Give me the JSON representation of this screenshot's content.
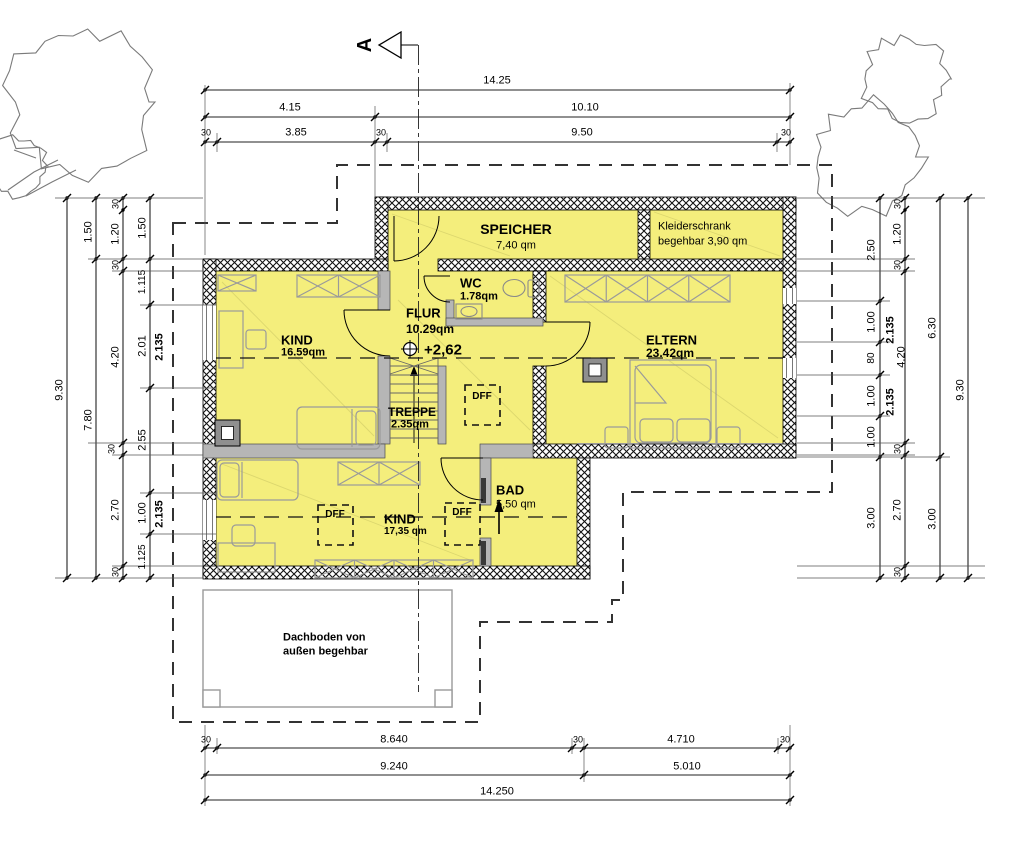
{
  "drawing": {
    "section_marker": "A",
    "attic_note": "Dachboden von außen begehbar",
    "roof_window_code": "DFF"
  },
  "rooms_summary": [
    {
      "name": "SPEICHER",
      "area": "7,40 qm"
    },
    {
      "name": "Kleiderschrank",
      "area": "begehbar 3,90 qm"
    },
    {
      "name": "WC",
      "area": "1.78qm"
    },
    {
      "name": "FLUR",
      "area": "10.29qm",
      "level": "+2,62"
    },
    {
      "name": "KIND",
      "area": "16.59qm"
    },
    {
      "name": "ELTERN",
      "area": "23.42qm"
    },
    {
      "name": "TREPPE",
      "area": "2.35qm"
    },
    {
      "name": "BAD",
      "area": "5,50 qm"
    },
    {
      "name": "KIND",
      "area": "17,35 qm"
    }
  ],
  "colors": {
    "room_fill": "#F4EE7C",
    "wall_gray": "#B6B6B6",
    "line_black": "#000000",
    "furniture_gray": "#9A9A9A",
    "tree_gray": "#7A7A7A"
  },
  "labels": {
    "rooms": [
      {
        "t": "SPEICHER",
        "x": 516,
        "y": 229,
        "s": 14,
        "b": 1,
        "n": "room-name-speicher"
      },
      {
        "t": "7,40 qm",
        "x": 516,
        "y": 246,
        "s": 11,
        "n": "room-area-speicher"
      },
      {
        "t": "Kleiderschrank",
        "x": 658,
        "y": 227,
        "s": 11,
        "a": "l",
        "n": "room-name-kleiderschrank"
      },
      {
        "t": "begehbar 3,90 qm",
        "x": 658,
        "y": 242,
        "s": 11,
        "a": "l",
        "n": "room-area-kleiderschrank"
      },
      {
        "t": "WC",
        "x": 460,
        "y": 283,
        "s": 13,
        "b": 1,
        "a": "l",
        "n": "room-name-wc"
      },
      {
        "t": "1.78qm",
        "x": 460,
        "y": 297,
        "s": 11,
        "b": 1,
        "a": "l",
        "n": "room-area-wc"
      },
      {
        "t": "FLUR",
        "x": 406,
        "y": 313,
        "s": 13,
        "b": 1,
        "a": "l",
        "n": "room-name-flur"
      },
      {
        "t": "10.29qm",
        "x": 406,
        "y": 329,
        "s": 12,
        "b": 1,
        "a": "l",
        "n": "room-area-flur"
      },
      {
        "t": "KIND",
        "x": 281,
        "y": 340,
        "s": 13,
        "b": 1,
        "a": "l",
        "n": "room-name-kind-1"
      },
      {
        "t": "16.59qm",
        "x": 281,
        "y": 353,
        "s": 11,
        "b": 1,
        "a": "l",
        "n": "room-area-kind-1"
      },
      {
        "t": "ELTERN",
        "x": 646,
        "y": 340,
        "s": 13,
        "b": 1,
        "a": "l",
        "n": "room-name-eltern"
      },
      {
        "t": "23.42qm",
        "x": 646,
        "y": 353,
        "s": 12,
        "b": 1,
        "a": "l",
        "n": "room-area-eltern"
      },
      {
        "t": "TREPPE",
        "x": 388,
        "y": 412,
        "s": 12,
        "b": 1,
        "a": "l",
        "n": "room-name-treppe"
      },
      {
        "t": "2.35qm",
        "x": 391,
        "y": 425,
        "s": 11,
        "b": 1,
        "a": "l",
        "n": "room-area-treppe"
      },
      {
        "t": "BAD",
        "x": 496,
        "y": 490,
        "s": 13,
        "b": 1,
        "a": "l",
        "n": "room-name-bad"
      },
      {
        "t": "5,50 qm",
        "x": 496,
        "y": 505,
        "s": 11,
        "a": "l",
        "n": "room-area-bad"
      },
      {
        "t": "KIND",
        "x": 384,
        "y": 519,
        "s": 13,
        "b": 1,
        "a": "l",
        "n": "room-name-kind-2"
      },
      {
        "t": "17,35 qm",
        "x": 384,
        "y": 532,
        "s": 10,
        "b": 1,
        "a": "l",
        "n": "room-area-kind-2"
      }
    ],
    "annotations": [
      {
        "t": "+2,62",
        "x": 424,
        "y": 350,
        "s": 15,
        "b": 1,
        "a": "l",
        "n": "level-annotation"
      },
      {
        "t": "DFF",
        "x": 482,
        "y": 397,
        "s": 10,
        "b": 1,
        "n": "dff-label-flur"
      },
      {
        "t": "DFF",
        "x": 335,
        "y": 515,
        "s": 10,
        "b": 1,
        "n": "dff-label-kind2-left"
      },
      {
        "t": "DFF",
        "x": 462,
        "y": 513,
        "s": 10,
        "b": 1,
        "n": "dff-label-kind2-right"
      },
      {
        "t": "Dachboden von",
        "x": 283,
        "y": 638,
        "s": 11,
        "b": 1,
        "a": "l",
        "n": "attic-note-line1"
      },
      {
        "t": "außen begehbar",
        "x": 283,
        "y": 652,
        "s": 11,
        "b": 1,
        "a": "l",
        "n": "attic-note-line2"
      },
      {
        "t": "A",
        "x": 365,
        "y": 45,
        "s": 20,
        "b": 1,
        "r": -90,
        "n": "section-marker-label"
      }
    ],
    "dims_top": [
      {
        "t": "14.25",
        "x": 497,
        "y": 81
      },
      {
        "t": "4.15",
        "x": 290,
        "y": 108
      },
      {
        "t": "10.10",
        "x": 585,
        "y": 108
      },
      {
        "t": "30",
        "x": 206,
        "y": 133,
        "s": 9
      },
      {
        "t": "3.85",
        "x": 296,
        "y": 133
      },
      {
        "t": "30",
        "x": 381,
        "y": 133,
        "s": 9
      },
      {
        "t": "9.50",
        "x": 582,
        "y": 133
      },
      {
        "t": "30",
        "x": 786,
        "y": 133,
        "s": 9
      }
    ],
    "dims_bottom": [
      {
        "t": "30",
        "x": 206,
        "y": 740,
        "s": 9
      },
      {
        "t": "8.640",
        "x": 394,
        "y": 740
      },
      {
        "t": "30",
        "x": 578,
        "y": 740,
        "s": 9
      },
      {
        "t": "4.710",
        "x": 681,
        "y": 740
      },
      {
        "t": "30",
        "x": 785,
        "y": 740,
        "s": 9
      },
      {
        "t": "9.240",
        "x": 394,
        "y": 767
      },
      {
        "t": "5.010",
        "x": 687,
        "y": 767
      },
      {
        "t": "14.250",
        "x": 497,
        "y": 792
      }
    ],
    "dims_left": [
      {
        "t": "9.30",
        "x": 60,
        "y": 390
      },
      {
        "t": "1.50",
        "x": 89,
        "y": 232
      },
      {
        "t": "7.80",
        "x": 89,
        "y": 420
      },
      {
        "t": "30",
        "x": 116,
        "y": 204,
        "s": 9
      },
      {
        "t": "1.20",
        "x": 116,
        "y": 234
      },
      {
        "t": "30",
        "x": 116,
        "y": 265,
        "s": 9
      },
      {
        "t": "4.20",
        "x": 116,
        "y": 357
      },
      {
        "t": "30",
        "x": 112,
        "y": 449,
        "s": 9
      },
      {
        "t": "2.70",
        "x": 116,
        "y": 510
      },
      {
        "t": "30",
        "x": 116,
        "y": 572,
        "s": 9
      },
      {
        "t": "1.50",
        "x": 143,
        "y": 228
      },
      {
        "t": "1.115",
        "x": 143,
        "y": 282,
        "s": 10
      },
      {
        "t": "2.01",
        "x": 143,
        "y": 346
      },
      {
        "t": "2.55",
        "x": 143,
        "y": 440
      },
      {
        "t": "1.00",
        "x": 143,
        "y": 513
      },
      {
        "t": "1.125",
        "x": 143,
        "y": 557,
        "s": 10
      },
      {
        "t": "2.135",
        "x": 160,
        "y": 347,
        "b": 1
      },
      {
        "t": "2.135",
        "x": 160,
        "y": 514,
        "b": 1
      }
    ],
    "dims_right": [
      {
        "t": "2.50",
        "x": 872,
        "y": 250
      },
      {
        "t": "1.00",
        "x": 872,
        "y": 322
      },
      {
        "t": "80",
        "x": 872,
        "y": 358,
        "s": 10
      },
      {
        "t": "1.00",
        "x": 872,
        "y": 396
      },
      {
        "t": "1.00",
        "x": 872,
        "y": 437
      },
      {
        "t": "3.00",
        "x": 872,
        "y": 518
      },
      {
        "t": "2.135",
        "x": 891,
        "y": 330,
        "b": 1
      },
      {
        "t": "2.135",
        "x": 891,
        "y": 402,
        "b": 1
      },
      {
        "t": "30",
        "x": 898,
        "y": 204,
        "s": 9
      },
      {
        "t": "1.20",
        "x": 898,
        "y": 234
      },
      {
        "t": "30",
        "x": 898,
        "y": 265,
        "s": 9
      },
      {
        "t": "4.20",
        "x": 902,
        "y": 357
      },
      {
        "t": "30",
        "x": 898,
        "y": 449,
        "s": 9
      },
      {
        "t": "2.70",
        "x": 898,
        "y": 510
      },
      {
        "t": "30",
        "x": 898,
        "y": 572,
        "s": 9
      },
      {
        "t": "6.30",
        "x": 933,
        "y": 328
      },
      {
        "t": "3.00",
        "x": 933,
        "y": 519
      },
      {
        "t": "9.30",
        "x": 961,
        "y": 390
      }
    ]
  }
}
